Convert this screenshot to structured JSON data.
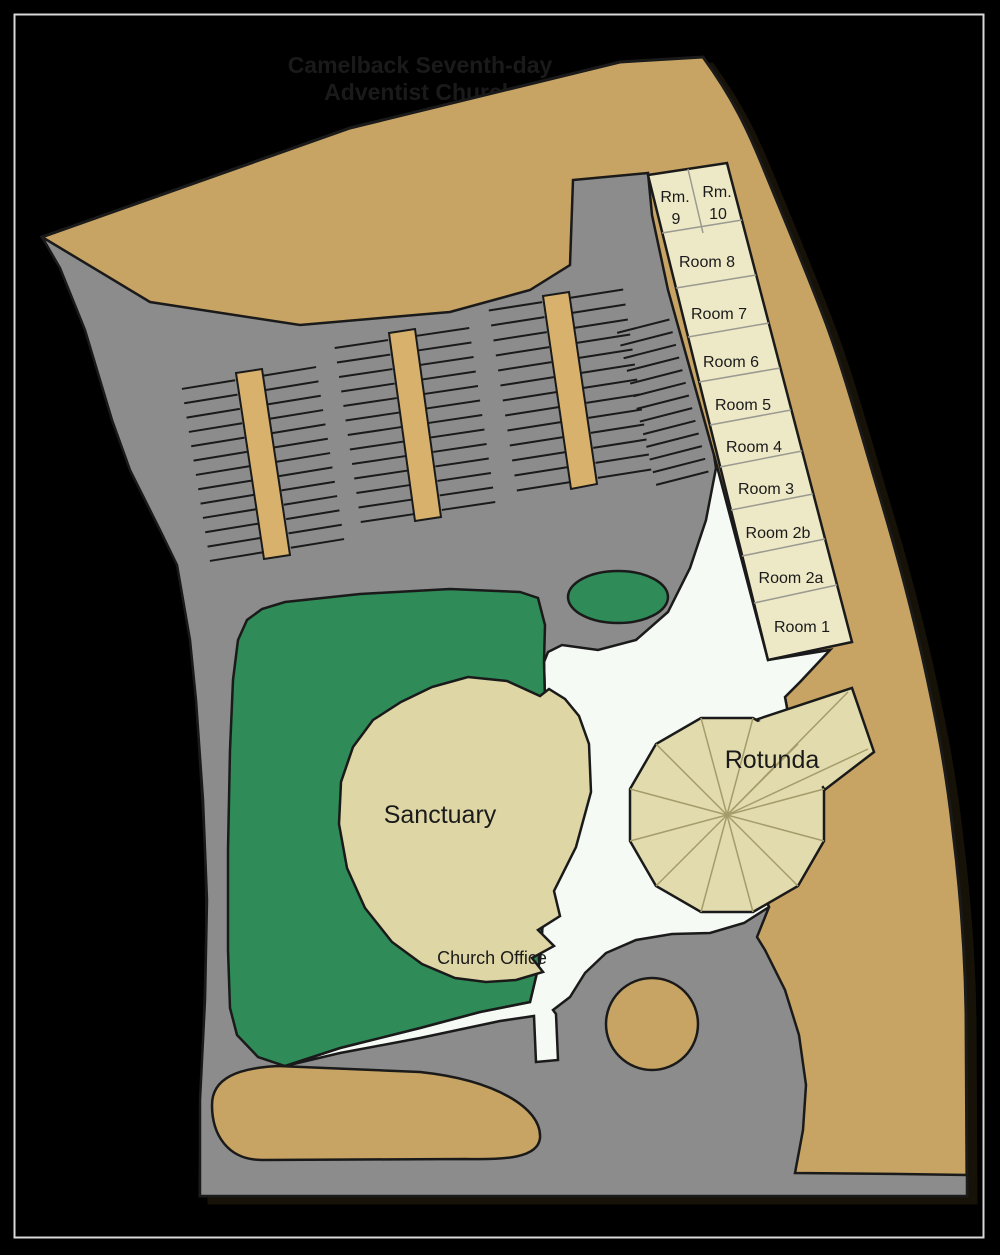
{
  "header": {
    "line1": "Camelback Seventh-day",
    "line2": "Adventist Church"
  },
  "buildings": {
    "sanctuary": {
      "label": "Sanctuary"
    },
    "rotunda": {
      "label": "Rotunda"
    },
    "church_office": {
      "label": "Church Office"
    },
    "rooms": {
      "r9": {
        "l1": "Rm.",
        "l2": "9"
      },
      "r10": {
        "l1": "Rm.",
        "l2": "10"
      },
      "r8": {
        "label": "Room 8"
      },
      "r7": {
        "label": "Room 7"
      },
      "r6": {
        "label": "Room 6"
      },
      "r5": {
        "label": "Room 5"
      },
      "r4": {
        "label": "Room 4"
      },
      "r3": {
        "label": "Room 3"
      },
      "r2b": {
        "label": "Room 2b"
      },
      "r2a": {
        "label": "Room 2a"
      },
      "r1": {
        "label": "Room 1"
      }
    }
  },
  "colors": {
    "background": "#000000",
    "frame": "#d8d8d8",
    "dirt": "#c7a464",
    "asphalt": "#8c8c8c",
    "parking_island": "#d8b26c",
    "lawn": "#2f8b57",
    "plaza": "#f5faf5",
    "rooms_building": "#ede8c6",
    "sanctuary_building": "#ded7a5",
    "rotunda_building": "#e2dbad",
    "outline": "#1a1a1a",
    "divider": "#9a9a90",
    "roof_line": "#a59c6b",
    "title_text": "#1d1d1d"
  }
}
